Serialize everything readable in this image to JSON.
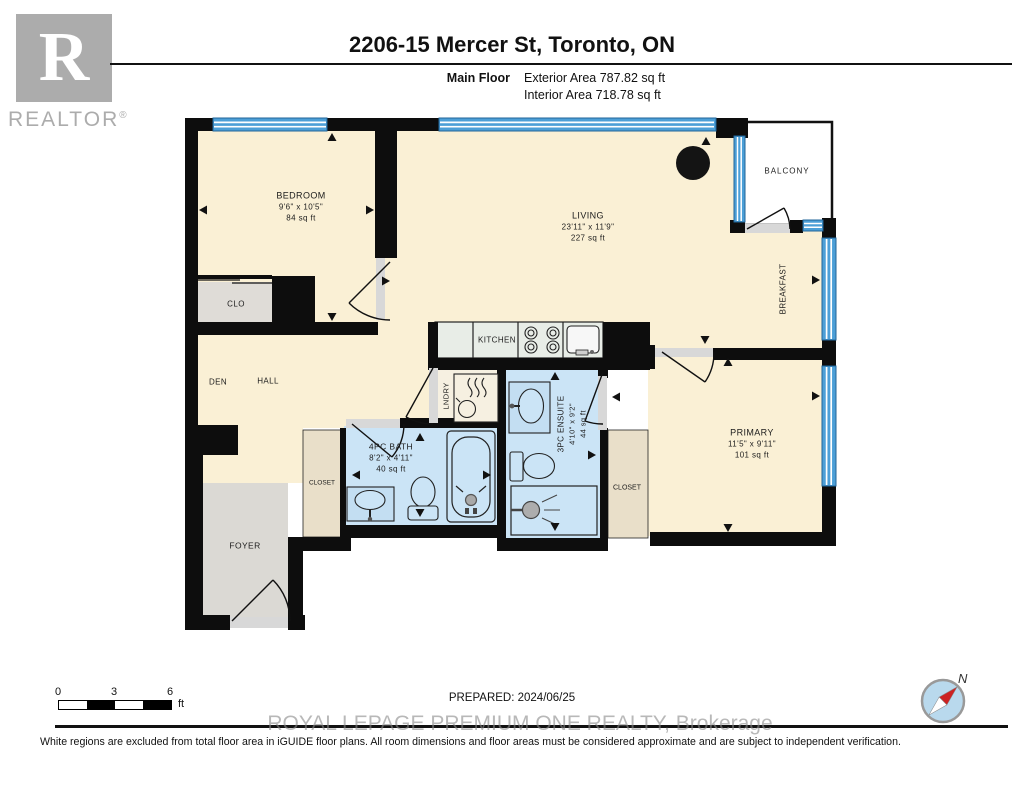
{
  "header": {
    "brand_letter": "R",
    "brand_name": "REALTOR",
    "brand_registered": "®",
    "title": "2206-15 Mercer St, Toronto, ON",
    "floor_label": "Main Floor",
    "exterior_area": "Exterior Area 787.82 sq ft",
    "interior_area": "Interior Area 718.78 sq ft"
  },
  "rooms": {
    "bedroom": {
      "name": "BEDROOM",
      "dims": "9'6\" x 10'5\"",
      "area": "84 sq ft"
    },
    "living": {
      "name": "LIVING",
      "dims": "23'11\" x 11'9\"",
      "area": "227 sq ft"
    },
    "primary": {
      "name": "PRIMARY",
      "dims": "11'5\" x 9'11\"",
      "area": "101 sq ft"
    },
    "ensuite": {
      "name": "3PC ENSUITE",
      "dims": "4'10\" x 9'2\"",
      "area": "44 sq ft"
    },
    "bath": {
      "name": "4PC BATH",
      "dims": "8'2\" x 4'11\"",
      "area": "40 sq ft"
    },
    "balcony": {
      "name": "BALCONY"
    },
    "breakfast": {
      "name": "BREAKFAST"
    },
    "kitchen": {
      "name": "KITCHEN"
    },
    "laundry": {
      "name": "LNDRY"
    },
    "den": {
      "name": "DEN"
    },
    "hall": {
      "name": "HALL"
    },
    "clo": {
      "name": "CLO"
    },
    "closet_hall": {
      "name": "CLOSET"
    },
    "closet_primary": {
      "name": "CLOSET"
    },
    "foyer": {
      "name": "FOYER"
    }
  },
  "scale_bar": {
    "tick_0": "0",
    "tick_3": "3",
    "tick_6": "6",
    "unit": "ft"
  },
  "footer": {
    "prepared": "PREPARED: 2024/06/25",
    "watermark": "ROYAL LEPAGE PREMIUM ONE REALTY, Brokerage",
    "disclaimer": "White regions are excluded from total floor area in iGUIDE floor plans. All room dimensions and floor areas must be considered approximate and are subject to independent verification."
  },
  "compass": {
    "north_label": "N"
  },
  "colors": {
    "wall": "#0d0d0d",
    "room_fill": "#FAF0D5",
    "bath_fill": "#CBE4F6",
    "window_blue": "#4C9FD7",
    "closet_tan": "#E9DFC9",
    "foyer_gray": "#DBD9D4",
    "counter_gray": "#E8EDE7",
    "compass_blue": "#B9D9ED",
    "needle_red": "#CC2222"
  }
}
